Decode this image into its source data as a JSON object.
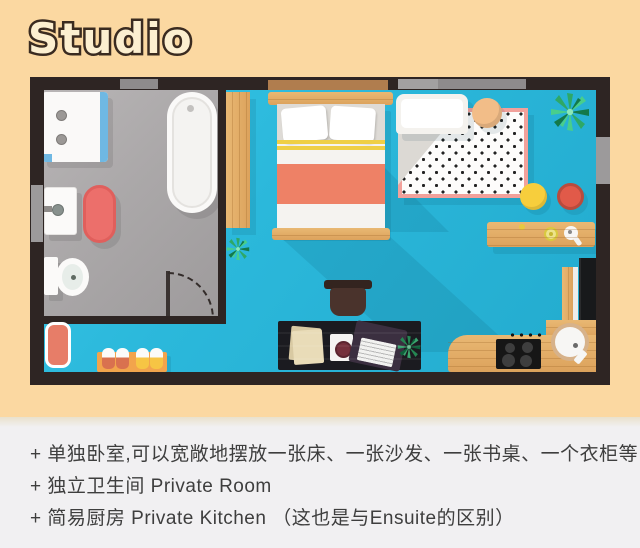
{
  "title": "Studio",
  "notes": {
    "items": [
      "+ 单独卧室,可以宽敞地摆放一张床、一张沙发、一张书桌、一个衣柜等",
      "+ 独立卫生间 Private Room",
      "+ 简易厨房 Private Kitchen （这也是与Ensuite的区别）"
    ]
  },
  "colors": {
    "page_background": "#FBD8A1",
    "wall": "#2E2523",
    "bathroom_floor": "#ABA8A9",
    "room_floor": "#2BB8DB",
    "notes_background": "#F1F0F2",
    "note_text": "#3E3E3E",
    "title_fill": "#FCEFD0",
    "title_outline": "#3A2B20",
    "wood": "#E2AB66",
    "bed_blanket_stripe": "#EE8166",
    "stool_yellow": "#F7CE3C",
    "stool_red": "#E15A49",
    "shower_glass_blue": "#6FB8E3",
    "bath_mat_red": "#EC6F6B",
    "rug_border_pink": "#F2A19B"
  },
  "floorplan": {
    "rooms": [
      "bathroom",
      "living-sleeping-area",
      "kitchen-corner",
      "entrance"
    ],
    "furniture": [
      "shower",
      "bathtub",
      "sink",
      "toilet",
      "bath-mat",
      "door",
      "wardrobe",
      "bed",
      "sofa",
      "polka-dot-rug",
      "ottoman",
      "plants",
      "side-table",
      "yellow-stool",
      "red-stool",
      "desk",
      "desk-chair",
      "laptop",
      "papers",
      "kitchen-counter",
      "stove",
      "kitchen-sink",
      "fridge",
      "entrance-mat",
      "shoe-rack",
      "windows"
    ]
  }
}
